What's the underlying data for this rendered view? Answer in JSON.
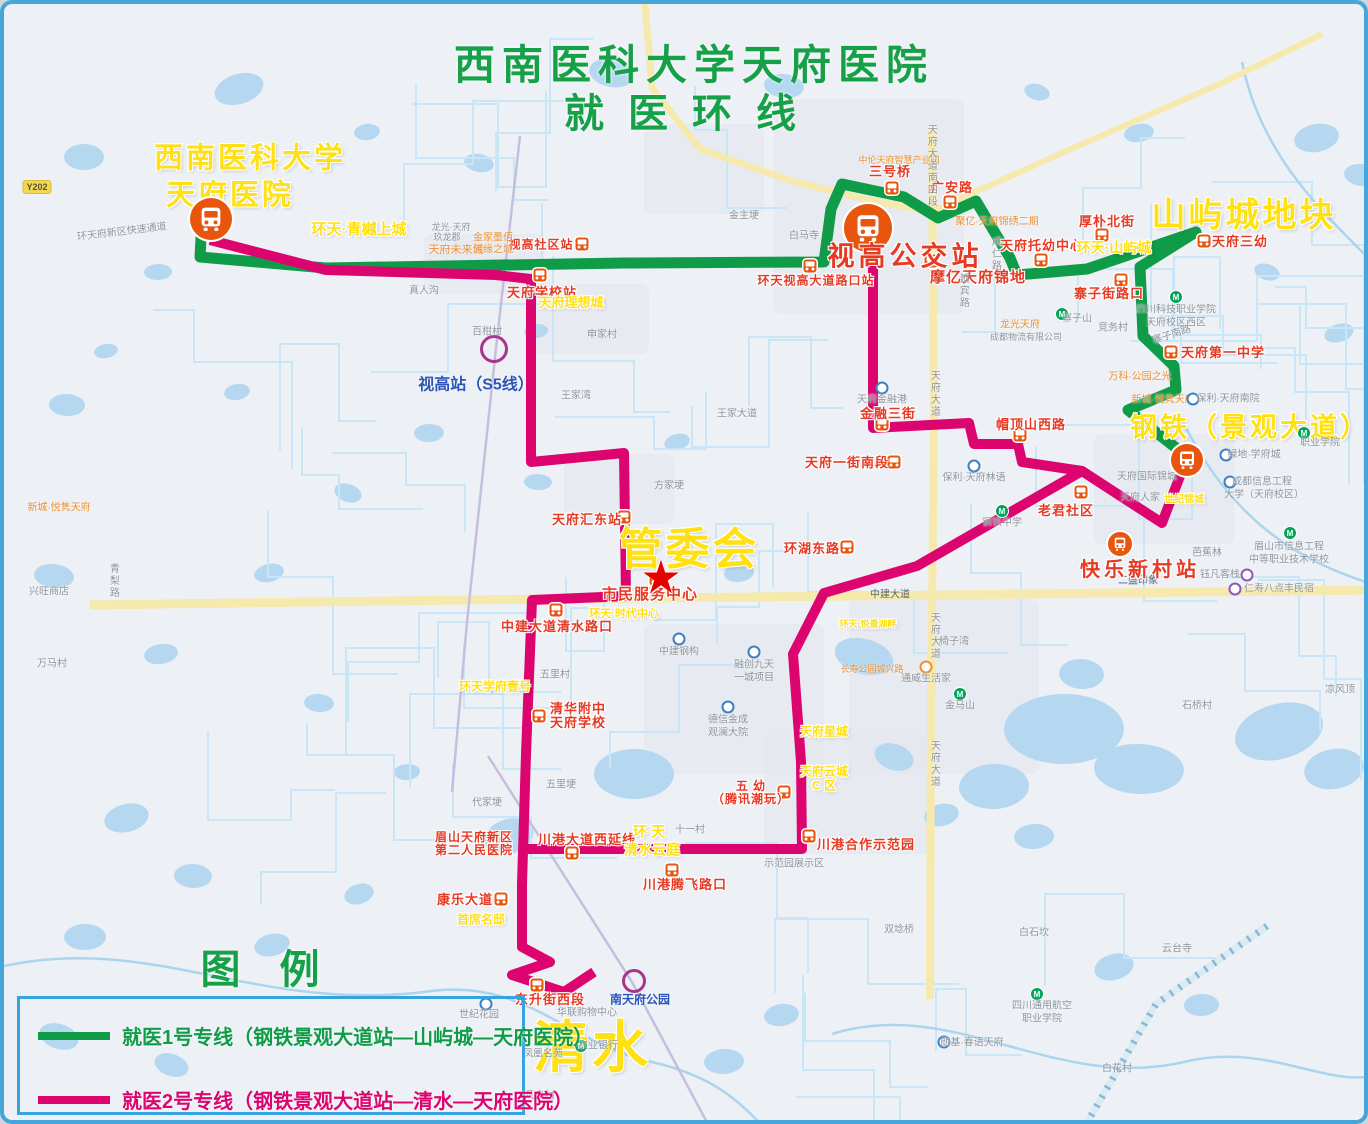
{
  "map_title": {
    "line1": "西南医科大学天府医院",
    "line2": "就医环线"
  },
  "legend": {
    "title": "图 例",
    "items": [
      {
        "label": "就医1号专线（钢铁景观大道站—山屿城—天府医院）",
        "line_color": "#0f9b47",
        "text_color": "#0f9b47"
      },
      {
        "label": "就医2号专线（钢铁景观大道站—清水—天府医院）",
        "line_color": "#dc0570",
        "text_color": "#dc0570"
      }
    ]
  },
  "colors": {
    "line1": "#0f9b47",
    "line2": "#dc0570",
    "water": "#b5d8f0",
    "road_yellow": "#f6e9ad",
    "stop_icon": "#e8560e",
    "title_green": "#16a048",
    "label_yellow": "#ffe013",
    "star_red": "#e60000",
    "border_blue": "#45a6db"
  },
  "major_labels": [
    {
      "id": "hospital-name-line1",
      "text": "西南医科大学",
      "x": 246,
      "y": 155,
      "size": 29
    },
    {
      "id": "hospital-name-line2",
      "text": "天府医院",
      "x": 226,
      "y": 192,
      "size": 29
    },
    {
      "id": "shanyucheng-area",
      "text": "山屿城地块",
      "x": 1240,
      "y": 212,
      "size": 34
    },
    {
      "id": "gangtie-area",
      "text": "钢铁（景观大道）",
      "x": 1246,
      "y": 424,
      "size": 27
    },
    {
      "id": "guanweihui",
      "text": "管委会",
      "x": 685,
      "y": 546,
      "size": 44
    },
    {
      "id": "qingshui-area",
      "text": "清水",
      "x": 588,
      "y": 1044,
      "size": 56
    }
  ],
  "star": {
    "x": 657,
    "y": 574,
    "size": 46,
    "glyph": "★"
  },
  "terminals": [
    {
      "name": "天府医院站",
      "x": 207,
      "y": 215,
      "r": 21
    },
    {
      "name": "视高公交站",
      "x": 864,
      "y": 224,
      "r": 24,
      "label": "视高公交站",
      "label_x": 901,
      "label_y": 253,
      "label_size": 27
    },
    {
      "name": "钢铁景观大道站",
      "x": 1183,
      "y": 456,
      "r": 16
    },
    {
      "name": "快乐新村站",
      "x": 1116,
      "y": 540,
      "r": 12,
      "label": "快乐新村站",
      "label_x": 1136,
      "label_y": 567,
      "label_size": 20
    }
  ],
  "rail_stations": [
    {
      "name": "视高站（S5线）",
      "cx": 490,
      "cy": 345,
      "r": 11,
      "lx": 472,
      "ly": 381,
      "lsize": 16
    },
    {
      "name": "南天府公园",
      "cx": 630,
      "cy": 977,
      "r": 9,
      "lx": 636,
      "ly": 996,
      "lsize": 12
    }
  ],
  "bus_stops": [
    {
      "name": "天府学校站",
      "ix": 536,
      "iy": 271,
      "lx": 538,
      "ly": 289
    },
    {
      "name": "视高社区站",
      "ix": 578,
      "iy": 240,
      "lx": 537,
      "ly": 241,
      "lsize": 12
    },
    {
      "name": "三号桥",
      "ix": 888,
      "iy": 184,
      "lx": 886,
      "ly": 168
    },
    {
      "name": "广安路",
      "ix": 946,
      "iy": 198,
      "lx": 948,
      "ly": 184
    },
    {
      "name": "摩亿天府锦地",
      "ix": 927,
      "iy": 257,
      "lx": 974,
      "ly": 274,
      "lsize": 15
    },
    {
      "name": "天府托幼中心",
      "ix": 1037,
      "iy": 256,
      "lx": 1038,
      "ly": 242
    },
    {
      "name": "厚朴北街",
      "ix": 1098,
      "iy": 231,
      "lx": 1103,
      "ly": 218
    },
    {
      "name": "环天视高大道路口站",
      "ix": 806,
      "iy": 262,
      "lx": 812,
      "ly": 277,
      "lsize": 12
    },
    {
      "name": "寨子街路口",
      "ix": 1117,
      "iy": 276,
      "lx": 1105,
      "ly": 290
    },
    {
      "name": "天府三幼",
      "ix": 1200,
      "iy": 237,
      "lx": 1236,
      "ly": 238
    },
    {
      "name": "天府第一中学",
      "ix": 1167,
      "iy": 348,
      "lx": 1219,
      "ly": 349
    },
    {
      "name": "金融三街",
      "ix": 878,
      "iy": 420,
      "lx": 884,
      "ly": 410
    },
    {
      "name": "帽顶山西路",
      "ix": 1016,
      "iy": 431,
      "lx": 1027,
      "ly": 421
    },
    {
      "name": "天府一街南段",
      "ix": 890,
      "iy": 458,
      "lx": 843,
      "ly": 459
    },
    {
      "name": "老君社区",
      "ix": 1077,
      "iy": 488,
      "lx": 1062,
      "ly": 507
    },
    {
      "name": "环湖东路",
      "ix": 843,
      "iy": 543,
      "lx": 808,
      "ly": 545
    },
    {
      "name": "天府汇东站",
      "ix": 620,
      "iy": 513,
      "lx": 583,
      "ly": 516
    },
    {
      "name": "市民服务中心",
      "ix": 652,
      "iy": 575,
      "lx": 646,
      "ly": 591,
      "lsize": 15
    },
    {
      "name": "中建大道清水路口",
      "ix": 552,
      "iy": 606,
      "lx": 553,
      "ly": 623
    },
    {
      "lines": [
        "清华附中",
        "天府学校"
      ],
      "name": "清华附中天府学校",
      "ix": 535,
      "iy": 712,
      "lx": 574,
      "ly": 712
    },
    {
      "lines": [
        "五 幼",
        "（腾讯潮玩）"
      ],
      "name": "五幼（腾讯潮玩）",
      "ix": 780,
      "iy": 788,
      "lx": 747,
      "ly": 789,
      "lsize": 12
    },
    {
      "name": "川港合作示范园",
      "ix": 805,
      "iy": 832,
      "lx": 862,
      "ly": 841
    },
    {
      "name": "川港腾飞路口",
      "ix": 668,
      "iy": 866,
      "lx": 681,
      "ly": 881
    },
    {
      "name": "川港大道西延线",
      "ix": 568,
      "iy": 849,
      "lx": 583,
      "ly": 836
    },
    {
      "name": "康乐大道",
      "ix": 497,
      "iy": 895,
      "lx": 461,
      "ly": 896
    },
    {
      "name": "东升街西段",
      "ix": 533,
      "iy": 981,
      "lx": 546,
      "ly": 996
    },
    {
      "lines": [
        "眉山天府新区",
        "第二人民医院"
      ],
      "name": "眉山天府新区第二人民医院",
      "lx": 470,
      "ly": 840,
      "lsize": 12
    }
  ],
  "area_labels": [
    {
      "text": "环天·青樾上城",
      "x": 355,
      "y": 226,
      "size": 15,
      "c": "yellow"
    },
    {
      "text": "环天·山屿城",
      "x": 1110,
      "y": 244,
      "size": 14,
      "c": "yellow"
    },
    {
      "text": "天府理想城",
      "x": 567,
      "y": 299,
      "size": 13,
      "c": "yellow"
    },
    {
      "text": "龙光·天府",
      "x": 447,
      "y": 224,
      "size": 9,
      "c": "gray"
    },
    {
      "text": "玖龙郡",
      "x": 443,
      "y": 234,
      "size": 9,
      "c": "gray"
    },
    {
      "text": "天府未来城",
      "x": 452,
      "y": 247,
      "size": 11,
      "c": "orange"
    },
    {
      "text": "金家墨佰",
      "x": 489,
      "y": 235,
      "size": 10,
      "c": "orange"
    },
    {
      "text": "佛缘之城",
      "x": 489,
      "y": 247,
      "size": 10,
      "c": "orange"
    },
    {
      "text": "聚亿·天府锦绣二期",
      "x": 993,
      "y": 219,
      "size": 10,
      "c": "orange"
    },
    {
      "text": "中伦天府智慧产业园",
      "x": 895,
      "y": 157,
      "size": 9,
      "c": "orange"
    },
    {
      "text": "龙光天府",
      "x": 1016,
      "y": 322,
      "size": 10,
      "c": "orange"
    },
    {
      "text": "成都物流有限公司",
      "x": 1022,
      "y": 334,
      "size": 9,
      "c": "gray"
    },
    {
      "text": "万科·公园之光",
      "x": 1136,
      "y": 374,
      "size": 10,
      "c": "orange"
    },
    {
      "text": "新城·悦隽天府",
      "x": 1159,
      "y": 397,
      "size": 10,
      "c": "orange"
    },
    {
      "text": "环天学府壹号",
      "x": 491,
      "y": 683,
      "size": 12,
      "c": "yellow"
    },
    {
      "text": "环天·时代中心",
      "x": 620,
      "y": 611,
      "size": 11,
      "c": "yellow"
    },
    {
      "text": "首席名邸",
      "x": 477,
      "y": 916,
      "size": 12,
      "c": "yellow"
    },
    {
      "text": "环 天",
      "x": 645,
      "y": 828,
      "size": 14,
      "c": "yellow"
    },
    {
      "text": "清水云庭",
      "x": 648,
      "y": 846,
      "size": 14,
      "c": "yellow"
    },
    {
      "text": "天府云城",
      "x": 820,
      "y": 768,
      "size": 12,
      "c": "yellow"
    },
    {
      "text": "C 区",
      "x": 820,
      "y": 782,
      "size": 12,
      "c": "yellow"
    },
    {
      "text": "天府星城",
      "x": 820,
      "y": 728,
      "size": 12,
      "c": "yellow"
    },
    {
      "text": "环天·悦景湖畔",
      "x": 864,
      "y": 621,
      "size": 9,
      "c": "yellow"
    },
    {
      "text": "长寿公园城兴路",
      "x": 868,
      "y": 666,
      "size": 9,
      "c": "orange"
    },
    {
      "text": "新城·悦隽天府",
      "x": 55,
      "y": 505,
      "size": 10,
      "c": "orange"
    },
    {
      "text": "世纪锦城",
      "x": 1180,
      "y": 497,
      "size": 10,
      "c": "yellow"
    }
  ],
  "minor_labels": [
    {
      "text": "真人沟",
      "x": 420,
      "y": 288
    },
    {
      "text": "百柑村",
      "x": 483,
      "y": 329
    },
    {
      "text": "申家村",
      "x": 598,
      "y": 332
    },
    {
      "text": "王家湾",
      "x": 572,
      "y": 393
    },
    {
      "text": "王家大道",
      "x": 733,
      "y": 411
    },
    {
      "text": "方家埂",
      "x": 665,
      "y": 483
    },
    {
      "text": "五里村",
      "x": 551,
      "y": 672
    },
    {
      "text": "五里埂",
      "x": 557,
      "y": 782
    },
    {
      "text": "代家埂",
      "x": 483,
      "y": 800
    },
    {
      "text": "十一村",
      "x": 686,
      "y": 827
    },
    {
      "text": "寨子山",
      "x": 1073,
      "y": 316,
      "m": "green",
      "mx": 1058,
      "my": 310
    },
    {
      "text": "竞务村",
      "x": 1109,
      "y": 325
    },
    {
      "text": "白马寺",
      "x": 800,
      "y": 233
    },
    {
      "text": "金主埂",
      "x": 740,
      "y": 213
    },
    {
      "text": "椅子湾",
      "x": 950,
      "y": 639
    },
    {
      "text": "金马山",
      "x": 956,
      "y": 703,
      "m": "green",
      "mx": 956,
      "my": 690
    },
    {
      "text": "石桥村",
      "x": 1193,
      "y": 703
    },
    {
      "text": "凉风顶",
      "x": 1336,
      "y": 687
    },
    {
      "text": "白花村",
      "x": 1113,
      "y": 1066
    },
    {
      "text": "云台寺",
      "x": 1173,
      "y": 946
    },
    {
      "text": "凡岛村",
      "x": 536,
      "y": 1093
    },
    {
      "text": "世纪花园",
      "x": 475,
      "y": 1012,
      "m": "blue",
      "mx": 482,
      "my": 1000
    },
    {
      "text": "凤凰名苑",
      "x": 539,
      "y": 1051
    },
    {
      "text": "华联购物中心",
      "x": 583,
      "y": 1010
    },
    {
      "text": "农业银行",
      "x": 594,
      "y": 1043,
      "m": "green",
      "mx": 577,
      "my": 1042
    },
    {
      "text": "中建钢构",
      "x": 675,
      "y": 649,
      "m": "blue",
      "mx": 675,
      "my": 635
    },
    {
      "text": "融创九天",
      "x": 750,
      "y": 662,
      "m": "blue",
      "mx": 750,
      "my": 648
    },
    {
      "text": "一城项目",
      "x": 750,
      "y": 675
    },
    {
      "text": "德信金成",
      "x": 724,
      "y": 717,
      "m": "blue",
      "mx": 724,
      "my": 703
    },
    {
      "text": "观澜大院",
      "x": 724,
      "y": 730
    },
    {
      "text": "保利·天府林语",
      "x": 970,
      "y": 475,
      "m": "blue",
      "mx": 970,
      "my": 462
    },
    {
      "text": "钢铁中学",
      "x": 998,
      "y": 520,
      "m": "green",
      "mx": 998,
      "my": 507
    },
    {
      "text": "天府金融港",
      "x": 878,
      "y": 397,
      "m": "blue",
      "mx": 878,
      "my": 384
    },
    {
      "text": "通威生活家",
      "x": 922,
      "y": 676,
      "m": "orange",
      "mx": 922,
      "my": 663
    },
    {
      "text": "示范园展示区",
      "x": 790,
      "y": 861
    },
    {
      "text": "二盛印象",
      "x": 1134,
      "y": 578,
      "dark": true
    },
    {
      "text": "芭蕉林",
      "x": 1203,
      "y": 550
    },
    {
      "text": "钰凡客栈",
      "x": 1216,
      "y": 572,
      "m": "purple",
      "mx": 1243,
      "my": 571
    },
    {
      "text": "仁寿八点丰民宿",
      "x": 1275,
      "y": 586,
      "m": "purple",
      "mx": 1231,
      "my": 585
    },
    {
      "text": "眉山市信息工程",
      "x": 1285,
      "y": 544,
      "m": "green",
      "mx": 1286,
      "my": 529
    },
    {
      "text": "中等职业技术学校",
      "x": 1285,
      "y": 557
    },
    {
      "text": "成都信息工程",
      "x": 1258,
      "y": 479,
      "m": "blue",
      "mx": 1226,
      "my": 478
    },
    {
      "text": "大学（天府校区）",
      "x": 1260,
      "y": 492
    },
    {
      "text": "绿地·学府城",
      "x": 1250,
      "y": 452,
      "m": "blue",
      "mx": 1222,
      "my": 451
    },
    {
      "text": "四川科技职业学院",
      "x": 1172,
      "y": 307,
      "m": "green",
      "mx": 1172,
      "my": 293
    },
    {
      "text": "天府校区西区",
      "x": 1172,
      "y": 320
    },
    {
      "text": "职业学院",
      "x": 1316,
      "y": 440,
      "m": "green",
      "mx": 1300,
      "my": 429
    },
    {
      "text": "四川通用航空",
      "x": 1038,
      "y": 1003,
      "m": "green",
      "mx": 1033,
      "my": 990
    },
    {
      "text": "职业学院",
      "x": 1038,
      "y": 1016
    },
    {
      "text": "朗基·春语天府",
      "x": 968,
      "y": 1040,
      "m": "blue",
      "mx": 940,
      "my": 1038
    },
    {
      "text": "保利·天府南院",
      "x": 1224,
      "y": 396,
      "m": "blue",
      "mx": 1189,
      "my": 395
    },
    {
      "text": "天府人家",
      "x": 1136,
      "y": 495
    },
    {
      "text": "天府国际锦城",
      "x": 1143,
      "y": 474
    },
    {
      "text": "兴旺商店",
      "x": 45,
      "y": 589
    },
    {
      "text": "万马村",
      "x": 48,
      "y": 661
    },
    {
      "text": "双埝桥",
      "x": 895,
      "y": 927
    },
    {
      "text": "白石坎",
      "x": 1030,
      "y": 930
    }
  ],
  "road_labels": [
    {
      "text": "天府大道",
      "x": 929,
      "y": 390,
      "vert": true
    },
    {
      "text": "天府大道",
      "x": 929,
      "y": 632,
      "vert": true
    },
    {
      "text": "天府大道",
      "x": 929,
      "y": 760,
      "vert": true
    },
    {
      "text": "天府大道南四段",
      "x": 926,
      "y": 162,
      "vert": true
    },
    {
      "text": "成仁路",
      "x": 990,
      "y": 250,
      "vert": true
    },
    {
      "text": "延宾路",
      "x": 958,
      "y": 287,
      "vert": true
    },
    {
      "text": "中建大道",
      "x": 886,
      "y": 592,
      "dark": true
    },
    {
      "text": "青梨路",
      "x": 108,
      "y": 577,
      "vert": true
    },
    {
      "text": "环天府新区快速通道",
      "x": 118,
      "y": 229,
      "rot": -7
    },
    {
      "text": "寨子南路",
      "x": 1168,
      "y": 332,
      "rot": -18
    }
  ],
  "badge": {
    "text": "Y202",
    "x": 33,
    "y": 183
  },
  "routes": {
    "line1": {
      "name": "就医1号专线",
      "color": "#0f9b47",
      "width": 11,
      "points": [
        [
          207,
          224
        ],
        [
          197,
          234
        ],
        [
          196,
          253
        ],
        [
          322,
          264
        ],
        [
          620,
          259
        ],
        [
          820,
          258
        ],
        [
          827,
          205
        ],
        [
          838,
          180
        ],
        [
          900,
          193
        ],
        [
          934,
          214
        ],
        [
          972,
          197
        ],
        [
          1006,
          254
        ],
        [
          1013,
          271
        ],
        [
          1083,
          265
        ],
        [
          1192,
          228
        ],
        [
          1136,
          263
        ],
        [
          1139,
          332
        ],
        [
          1170,
          362
        ],
        [
          1172,
          386
        ],
        [
          1124,
          406
        ],
        [
          1181,
          451
        ]
      ]
    },
    "line2": {
      "name": "就医2号专线",
      "color": "#dc0570",
      "width": 10,
      "polylines": [
        [
          [
            206,
            236
          ],
          [
            322,
            266
          ],
          [
            492,
            271
          ],
          [
            527,
            275
          ],
          [
            527,
            458
          ],
          [
            620,
            449
          ],
          [
            622,
            592
          ],
          [
            528,
            596
          ],
          [
            522,
            750
          ],
          [
            518,
            880
          ],
          [
            518,
            943
          ],
          [
            546,
            958
          ],
          [
            508,
            971
          ],
          [
            560,
            988
          ],
          [
            590,
            968
          ]
        ],
        [
          [
            520,
            845
          ],
          [
            798,
            845
          ],
          [
            797,
            758
          ],
          [
            789,
            650
          ],
          [
            820,
            589
          ],
          [
            913,
            562
          ],
          [
            1078,
            467
          ],
          [
            1158,
            519
          ],
          [
            1181,
            459
          ]
        ],
        [
          [
            869,
            250
          ],
          [
            869,
            424
          ],
          [
            965,
            419
          ],
          [
            970,
            440
          ],
          [
            1014,
            440
          ],
          [
            1018,
            458
          ],
          [
            1078,
            467
          ]
        ]
      ]
    }
  }
}
